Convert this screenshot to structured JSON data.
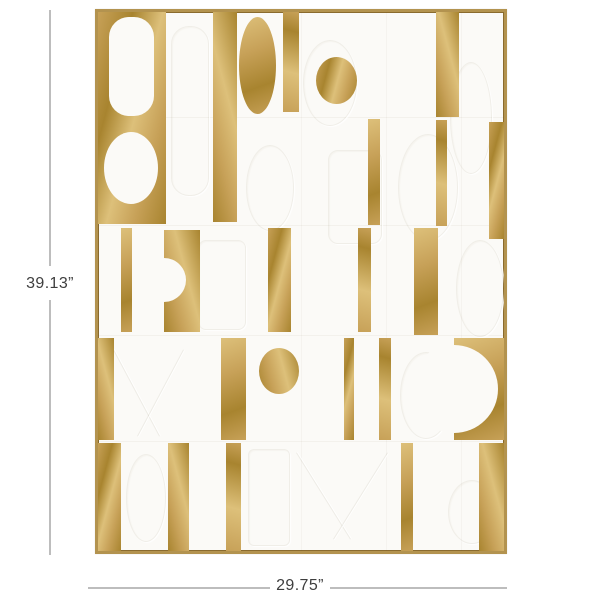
{
  "page": {
    "background": "#ffffff"
  },
  "dimensions": {
    "height_label": "39.13”",
    "width_label": "29.75”",
    "line_color": "#bdbdbd",
    "text_color": "#3e3e3e"
  },
  "artwork": {
    "frame_color": "#b3934f",
    "frame_edge_color": "#8a6b2e",
    "canvas_color": "#fbfaf7",
    "gold_base": "#c7a158",
    "gold_light": "#ddc07a",
    "gold_dark": "#a8842f",
    "shapes": [
      {
        "name": "seam-row-1",
        "kind": "seam-h",
        "x": 0,
        "y": 105,
        "w": 406,
        "h": 1
      },
      {
        "name": "seam-row-2",
        "kind": "seam-h",
        "x": 0,
        "y": 213,
        "w": 406,
        "h": 1
      },
      {
        "name": "seam-row-3",
        "kind": "seam-h",
        "x": 0,
        "y": 323,
        "w": 406,
        "h": 1
      },
      {
        "name": "seam-row-4",
        "kind": "seam-h",
        "x": 0,
        "y": 429,
        "w": 406,
        "h": 1
      },
      {
        "name": "seam-col-1",
        "kind": "seam-v",
        "x": 203,
        "y": 0,
        "w": 1,
        "h": 539
      },
      {
        "name": "seam-col-2",
        "kind": "seam-v",
        "x": 288,
        "y": 0,
        "w": 1,
        "h": 539
      },
      {
        "name": "seam-col-3",
        "kind": "seam-v",
        "x": 363,
        "y": 0,
        "w": 1,
        "h": 539
      },
      {
        "name": "emboss-capsule-top",
        "kind": "emboss-rect",
        "x": 73,
        "y": 14,
        "w": 36,
        "h": 168,
        "r": 18
      },
      {
        "name": "emboss-oval-top-mid",
        "kind": "emboss-ellipse",
        "x": 205,
        "y": 28,
        "w": 52,
        "h": 84
      },
      {
        "name": "emboss-wave-top-right",
        "kind": "emboss-ellipse",
        "x": 352,
        "y": 50,
        "w": 40,
        "h": 110
      },
      {
        "name": "emboss-oval-band2-left",
        "kind": "emboss-ellipse",
        "x": 148,
        "y": 133,
        "w": 46,
        "h": 84
      },
      {
        "name": "emboss-rect-band2-mid",
        "kind": "emboss-rect",
        "x": 230,
        "y": 138,
        "w": 52,
        "h": 92,
        "r": 10
      },
      {
        "name": "emboss-oval-band2-right",
        "kind": "emboss-ellipse",
        "x": 300,
        "y": 122,
        "w": 58,
        "h": 105
      },
      {
        "name": "emboss-rect-band3",
        "kind": "emboss-rect",
        "x": 100,
        "y": 228,
        "w": 46,
        "h": 88,
        "r": 8
      },
      {
        "name": "emboss-oval-band3-right",
        "kind": "emboss-ellipse",
        "x": 358,
        "y": 228,
        "w": 46,
        "h": 95
      },
      {
        "name": "emboss-diag-band4-a",
        "kind": "emboss-line",
        "x": 38,
        "y": 332,
        "w": 1,
        "h": 98,
        "rot": -28
      },
      {
        "name": "emboss-diag-band4-b",
        "kind": "emboss-line",
        "x": 62,
        "y": 332,
        "w": 1,
        "h": 98,
        "rot": 28
      },
      {
        "name": "emboss-oval-band4-right",
        "kind": "emboss-ellipse",
        "x": 302,
        "y": 340,
        "w": 50,
        "h": 85
      },
      {
        "name": "emboss-rect-band5",
        "kind": "emboss-rect",
        "x": 150,
        "y": 437,
        "w": 40,
        "h": 95,
        "r": 6
      },
      {
        "name": "emboss-diag-band5-a",
        "kind": "emboss-line",
        "x": 225,
        "y": 433,
        "w": 1,
        "h": 102,
        "rot": -32
      },
      {
        "name": "emboss-diag-band5-b",
        "kind": "emboss-line",
        "x": 262,
        "y": 433,
        "w": 1,
        "h": 102,
        "rot": 32
      },
      {
        "name": "emboss-oval-band5-right",
        "kind": "emboss-ellipse",
        "x": 350,
        "y": 468,
        "w": 46,
        "h": 62
      },
      {
        "name": "emboss-oval-band5-left",
        "kind": "emboss-ellipse",
        "x": 28,
        "y": 442,
        "w": 38,
        "h": 86
      },
      {
        "name": "gold-block-top-left",
        "kind": "gold-rect",
        "x": 0,
        "y": 0,
        "w": 68,
        "h": 212
      },
      {
        "name": "white-capsule-cutout",
        "kind": "white-rect",
        "x": 11,
        "y": 5,
        "w": 45,
        "h": 99,
        "r": 20
      },
      {
        "name": "white-circle-cutout",
        "kind": "white-ellipse",
        "x": 6,
        "y": 120,
        "w": 54,
        "h": 72
      },
      {
        "name": "gold-stripe-tall-left",
        "kind": "gold-rect",
        "g": 1,
        "x": 115,
        "y": 0,
        "w": 24,
        "h": 210
      },
      {
        "name": "gold-egg",
        "kind": "gold-ellipse",
        "g": 2,
        "x": 141,
        "y": 5,
        "w": 37,
        "h": 97
      },
      {
        "name": "gold-stripe-top-mid",
        "kind": "gold-rect",
        "g": 3,
        "x": 185,
        "y": 0,
        "w": 16,
        "h": 100
      },
      {
        "name": "gold-circle-top",
        "kind": "gold-ellipse",
        "x": 218,
        "y": 45,
        "w": 41,
        "h": 47
      },
      {
        "name": "gold-stripe-band2-mid",
        "kind": "gold-rect",
        "g": 2,
        "x": 270,
        "y": 107,
        "w": 12,
        "h": 106
      },
      {
        "name": "gold-stripe-top-right-wide",
        "kind": "gold-rect",
        "g": 1,
        "x": 338,
        "y": 0,
        "w": 23,
        "h": 105
      },
      {
        "name": "gold-stripe-band2-right",
        "kind": "gold-rect",
        "g": 3,
        "x": 338,
        "y": 108,
        "w": 11,
        "h": 106
      },
      {
        "name": "gold-stripe-band2-edge",
        "kind": "gold-rect",
        "x": 391,
        "y": 110,
        "w": 15,
        "h": 117
      },
      {
        "name": "gold-stripe-band3-a",
        "kind": "gold-rect",
        "g": 2,
        "x": 23,
        "y": 216,
        "w": 11,
        "h": 104
      },
      {
        "name": "gold-rect-band3-notched",
        "kind": "gold-rect",
        "g": 1,
        "x": 66,
        "y": 218,
        "w": 36,
        "h": 102
      },
      {
        "name": "white-notch-circle",
        "kind": "white-ellipse",
        "x": 44,
        "y": 246,
        "w": 44,
        "h": 44
      },
      {
        "name": "gold-stripe-band3-b",
        "kind": "gold-rect",
        "x": 170,
        "y": 216,
        "w": 23,
        "h": 104
      },
      {
        "name": "gold-stripe-band3-c",
        "kind": "gold-rect",
        "g": 3,
        "x": 260,
        "y": 216,
        "w": 13,
        "h": 104
      },
      {
        "name": "gold-stripe-band3-d",
        "kind": "gold-rect",
        "g": 2,
        "x": 316,
        "y": 216,
        "w": 24,
        "h": 107
      },
      {
        "name": "gold-column-band4-left",
        "kind": "gold-rect",
        "g": 1,
        "x": 0,
        "y": 326,
        "w": 16,
        "h": 102
      },
      {
        "name": "gold-stripe-band4-a",
        "kind": "gold-rect",
        "g": 2,
        "x": 123,
        "y": 326,
        "w": 25,
        "h": 102
      },
      {
        "name": "gold-oval-band4",
        "kind": "gold-ellipse",
        "g": 1,
        "x": 161,
        "y": 336,
        "w": 40,
        "h": 46
      },
      {
        "name": "gold-stripe-band4-b",
        "kind": "gold-rect",
        "x": 246,
        "y": 326,
        "w": 10,
        "h": 102
      },
      {
        "name": "gold-stripe-band4-c",
        "kind": "gold-rect",
        "g": 3,
        "x": 281,
        "y": 326,
        "w": 12,
        "h": 102
      },
      {
        "name": "gold-block-band4-right",
        "kind": "gold-rect",
        "g": 2,
        "x": 356,
        "y": 326,
        "w": 50,
        "h": 102
      },
      {
        "name": "white-semicircle-notch",
        "kind": "white-ellipse",
        "x": 312,
        "y": 333,
        "w": 88,
        "h": 88
      },
      {
        "name": "gold-column-band5-left",
        "kind": "gold-rect",
        "x": 0,
        "y": 431,
        "w": 23,
        "h": 108
      },
      {
        "name": "gold-stripe-band5-a",
        "kind": "gold-rect",
        "g": 1,
        "x": 70,
        "y": 431,
        "w": 21,
        "h": 108
      },
      {
        "name": "gold-stripe-band5-b",
        "kind": "gold-rect",
        "g": 3,
        "x": 128,
        "y": 431,
        "w": 15,
        "h": 108
      },
      {
        "name": "gold-stripe-band5-c",
        "kind": "gold-rect",
        "g": 2,
        "x": 303,
        "y": 431,
        "w": 12,
        "h": 108
      },
      {
        "name": "gold-block-band5-right",
        "kind": "gold-rect",
        "g": 1,
        "x": 381,
        "y": 431,
        "w": 25,
        "h": 108
      }
    ]
  },
  "annotation_geometry": {
    "vertical_line": {
      "x": 49,
      "top_y1": 10,
      "top_y2": 266,
      "bottom_y1": 300,
      "bottom_y2": 555
    },
    "horizontal_line": {
      "y": 587,
      "left_x1": 88,
      "left_x2": 270,
      "right_x1": 330,
      "right_x2": 507
    },
    "height_label_center": {
      "x": 50,
      "y": 284
    },
    "width_label_center": {
      "x": 300,
      "y": 586
    }
  }
}
